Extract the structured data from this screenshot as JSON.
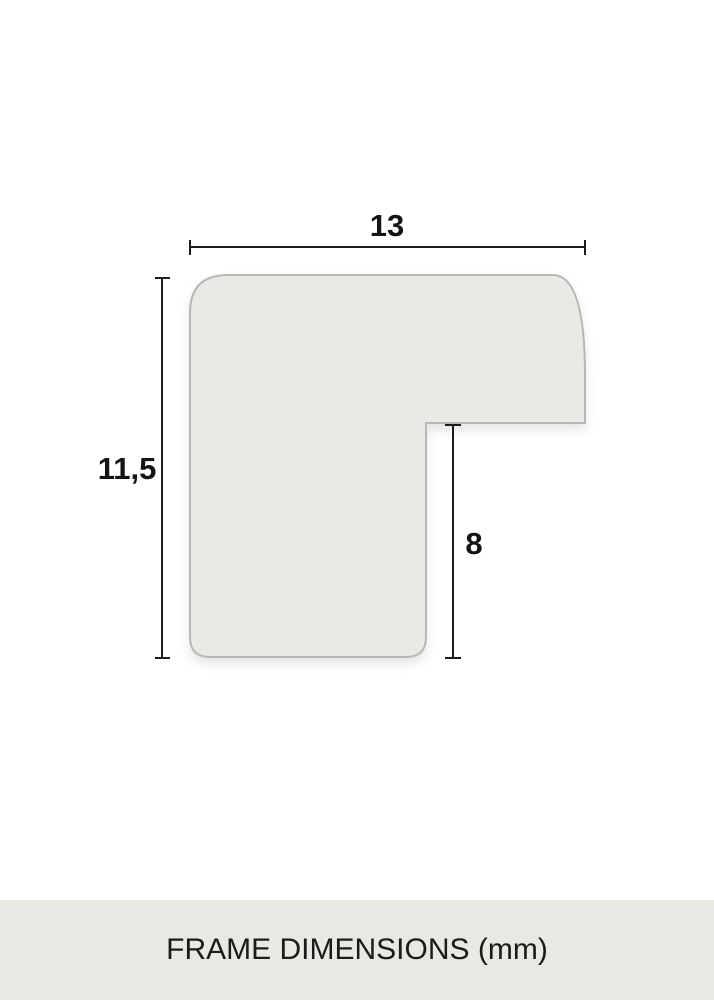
{
  "diagram": {
    "type": "frame-profile-cross-section",
    "dimensions": {
      "width": {
        "value": "13"
      },
      "height": {
        "value": "11,5"
      },
      "rabbet_depth": {
        "value": "8"
      }
    },
    "footer": {
      "label": "FRAME DIMENSIONS (mm)"
    },
    "colors": {
      "background": "#ffffff",
      "profile_fill": "#eaeae5",
      "profile_stroke": "#b7b7b3",
      "dimension_line": "#1c1c1c",
      "label_text": "#141414",
      "footer_bar": "#e9e8e3",
      "footer_text": "#1b1b1b"
    }
  }
}
